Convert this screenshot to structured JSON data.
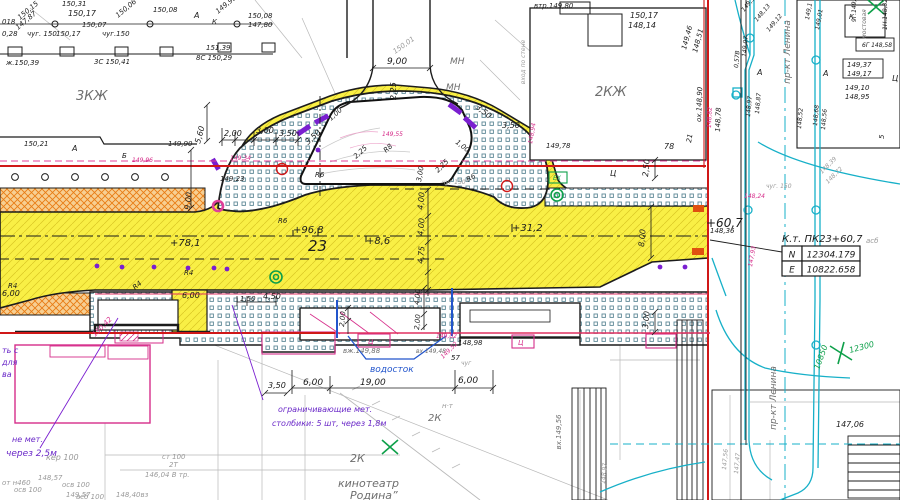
{
  "palette": {
    "k": "#1c1c1c",
    "g": "#9a9a9a",
    "G": "#6e6e6e",
    "p": "#d62d8a",
    "P": "#6a28c8",
    "r": "#d01818",
    "b": "#2255cc",
    "c": "#15aabb",
    "n": "#0ea04a",
    "o": "#e06010",
    "road_yellow": "#f9ef45",
    "orange": "#e87c14",
    "stipple": "#5e8896"
  },
  "coord_table": {
    "title": "К.т. ПК23+60,7",
    "rows": [
      {
        "label": "N",
        "value": "12304.179"
      },
      {
        "label": "E",
        "value": "10822.658"
      }
    ]
  },
  "labels": [
    {
      "t": "150,31",
      "x": 62,
      "y": 6
    },
    {
      "t": "150,15",
      "x": 20,
      "y": 20,
      "r": -40
    },
    {
      "t": "147,87",
      "x": 18,
      "y": 30,
      "r": -40
    },
    {
      "t": "150,17",
      "x": 68,
      "y": 16,
      "s": 8
    },
    {
      "t": "150,06",
      "x": 118,
      "y": 18,
      "r": -40
    },
    {
      "t": "150,08",
      "x": 153,
      "y": 12
    },
    {
      "t": "А",
      "x": 194,
      "y": 18,
      "s": 8
    },
    {
      "t": "К",
      "x": 212,
      "y": 24
    },
    {
      "t": "149,93",
      "x": 218,
      "y": 14,
      "r": -40
    },
    {
      "t": "150,08",
      "x": 248,
      "y": 18
    },
    {
      "t": "147,80",
      "x": 248,
      "y": 27
    },
    {
      "t": "018",
      "x": 2,
      "y": 24
    },
    {
      "t": "0,28",
      "x": 2,
      "y": 36
    },
    {
      "t": "чуг. 150",
      "x": 27,
      "y": 36
    },
    {
      "t": "150,17",
      "x": 56,
      "y": 36
    },
    {
      "t": "чуг.150",
      "x": 102,
      "y": 36
    },
    {
      "t": "150,07",
      "x": 82,
      "y": 27
    },
    {
      "t": "ж.150,39",
      "x": 6,
      "y": 65
    },
    {
      "t": "3С 150,41",
      "x": 94,
      "y": 64
    },
    {
      "t": "8С 150,29",
      "x": 196,
      "y": 60
    },
    {
      "t": "151,39",
      "x": 206,
      "y": 50
    },
    {
      "t": "3КЖ",
      "x": 76,
      "y": 100,
      "s": 13,
      "c": "G"
    },
    {
      "t": "150,21",
      "x": 24,
      "y": 146
    },
    {
      "t": "А",
      "x": 72,
      "y": 151,
      "s": 8
    },
    {
      "t": "149,90",
      "x": 168,
      "y": 146
    },
    {
      "t": "Б",
      "x": 122,
      "y": 158
    },
    {
      "t": "149,96",
      "x": 132,
      "y": 162,
      "c": "p",
      "s": 6
    },
    {
      "t": "9,00",
      "x": 387,
      "y": 64,
      "s": 9
    },
    {
      "t": "150,01",
      "x": 395,
      "y": 54,
      "r": -35,
      "c": "g"
    },
    {
      "t": "МН",
      "x": 450,
      "y": 64,
      "s": 9,
      "c": "G"
    },
    {
      "t": "МН",
      "x": 446,
      "y": 90,
      "s": 9,
      "c": "G"
    },
    {
      "t": "2,25",
      "x": 396,
      "y": 100,
      "r": -90,
      "s": 8
    },
    {
      "t": "втр.149,80",
      "x": 534,
      "y": 8
    },
    {
      "t": "2,00",
      "x": 224,
      "y": 136,
      "s": 8
    },
    {
      "t": "3,00",
      "x": 256,
      "y": 133,
      "s": 8
    },
    {
      "t": "3,50",
      "x": 279,
      "y": 136,
      "s": 8
    },
    {
      "t": "5,60",
      "x": 200,
      "y": 144,
      "r": -75,
      "s": 8
    },
    {
      "t": "3,50",
      "x": 308,
      "y": 145,
      "r": -42,
      "s": 8
    },
    {
      "t": "1,00",
      "x": 331,
      "y": 121,
      "r": -42
    },
    {
      "t": "2,25",
      "x": 356,
      "y": 159,
      "r": -42
    },
    {
      "t": "R8",
      "x": 386,
      "y": 153,
      "r": -42
    },
    {
      "t": "R6",
      "x": 315,
      "y": 177
    },
    {
      "t": "R6",
      "x": 468,
      "y": 182,
      "r": -30
    },
    {
      "t": "3,00",
      "x": 421,
      "y": 182,
      "r": -80
    },
    {
      "t": "2,25",
      "x": 438,
      "y": 173,
      "r": -45
    },
    {
      "t": "1,00",
      "x": 455,
      "y": 143,
      "r": 38
    },
    {
      "t": "3,50",
      "x": 475,
      "y": 108,
      "r": 38,
      "s": 8
    },
    {
      "t": "3,50",
      "x": 502,
      "y": 128,
      "s": 8
    },
    {
      "t": "149,55",
      "x": 382,
      "y": 136,
      "c": "p",
      "s": 6
    },
    {
      "t": "чуг 150",
      "x": 442,
      "y": 184,
      "c": "g",
      "s": 6
    },
    {
      "t": "9,00",
      "x": 190,
      "y": 210,
      "r": -85,
      "s": 8
    },
    {
      "t": "149,78",
      "x": 546,
      "y": 148
    },
    {
      "t": "148,94",
      "x": 532,
      "y": 144,
      "r": -80,
      "c": "p",
      "s": 6
    },
    {
      "t": "149,34",
      "x": 230,
      "y": 160,
      "c": "p",
      "s": 6
    },
    {
      "t": "149,23",
      "x": 220,
      "y": 181
    },
    {
      "t": "150,17",
      "x": 630,
      "y": 18,
      "s": 8
    },
    {
      "t": "148,14",
      "x": 628,
      "y": 28,
      "s": 8
    },
    {
      "t": "2КЖ",
      "x": 595,
      "y": 96,
      "s": 13,
      "c": "G"
    },
    {
      "t": "149,46",
      "x": 686,
      "y": 50,
      "r": -75
    },
    {
      "t": "148,51",
      "x": 697,
      "y": 53,
      "r": -75
    },
    {
      "t": "149,37",
      "x": 744,
      "y": 12,
      "r": -50,
      "s": 6
    },
    {
      "t": "148,13",
      "x": 757,
      "y": 22,
      "r": -50,
      "s": 6
    },
    {
      "t": "149,12",
      "x": 769,
      "y": 32,
      "r": -50,
      "s": 6
    },
    {
      "t": "пр-кт Ленина",
      "x": 790,
      "y": 52,
      "r": -90,
      "s": 9,
      "c": "G",
      "a": "middle"
    },
    {
      "t": "149,1",
      "x": 809,
      "y": 20,
      "r": -80,
      "s": 6
    },
    {
      "t": "149,01",
      "x": 819,
      "y": 30,
      "r": -80,
      "s": 6
    },
    {
      "t": "ох.148,90",
      "x": 701,
      "y": 122,
      "r": -88
    },
    {
      "t": "148,82",
      "x": 711,
      "y": 128,
      "r": -88,
      "c": "p",
      "s": 6
    },
    {
      "t": "148,78",
      "x": 720,
      "y": 132,
      "r": -88
    },
    {
      "t": "78",
      "x": 664,
      "y": 149,
      "s": 8
    },
    {
      "t": "21",
      "x": 691,
      "y": 143,
      "r": -80
    },
    {
      "t": "мостовая",
      "x": 866,
      "y": 24,
      "r": -90,
      "s": 6,
      "c": "G",
      "a": "middle"
    },
    {
      "t": "К",
      "x": 849,
      "y": 19
    },
    {
      "t": "1Н.148,32",
      "x": 887,
      "y": 30,
      "r": -90,
      "s": 6
    },
    {
      "t": "9Г.149,46",
      "x": 856,
      "y": 22,
      "r": -90,
      "s": 6
    },
    {
      "t": "6Г 148,58",
      "x": 862,
      "y": 47,
      "s": 6
    },
    {
      "t": "149,37",
      "x": 847,
      "y": 67
    },
    {
      "t": "149,17",
      "x": 847,
      "y": 76
    },
    {
      "t": "149,10",
      "x": 845,
      "y": 90
    },
    {
      "t": "148,95",
      "x": 845,
      "y": 99
    },
    {
      "t": "Ц",
      "x": 892,
      "y": 81,
      "s": 8
    },
    {
      "t": "5",
      "x": 884,
      "y": 139,
      "r": -90
    },
    {
      "t": "А",
      "x": 757,
      "y": 75,
      "s": 8
    },
    {
      "t": "А",
      "x": 823,
      "y": 76,
      "s": 8
    },
    {
      "t": "149,07",
      "x": 746,
      "y": 57,
      "r": -85,
      "s": 6
    },
    {
      "t": "0,57В",
      "x": 738,
      "y": 68,
      "r": -85,
      "s": 6
    },
    {
      "t": "148,97",
      "x": 750,
      "y": 117,
      "r": -85,
      "s": 6
    },
    {
      "t": "148,87",
      "x": 759,
      "y": 114,
      "r": -85,
      "s": 6
    },
    {
      "t": "148,68",
      "x": 817,
      "y": 126,
      "r": -85,
      "s": 6
    },
    {
      "t": "148,56",
      "x": 825,
      "y": 130,
      "r": -85,
      "s": 6
    },
    {
      "t": "148,52",
      "x": 801,
      "y": 129,
      "r": -85,
      "s": 6
    },
    {
      "t": "чуг. 150",
      "x": 766,
      "y": 188,
      "c": "g",
      "s": 6
    },
    {
      "t": "148,24",
      "x": 744,
      "y": 198,
      "c": "p",
      "s": 6
    },
    {
      "t": "148,39",
      "x": 822,
      "y": 174,
      "r": -45,
      "c": "g",
      "s": 6
    },
    {
      "t": "148,72",
      "x": 828,
      "y": 184,
      "r": -45,
      "c": "g",
      "s": 6
    },
    {
      "t": "Ц",
      "x": 610,
      "y": 176,
      "s": 8
    },
    {
      "t": "вход по стене",
      "x": 525,
      "y": 62,
      "r": -90,
      "s": 6,
      "c": "g",
      "a": "middle"
    },
    {
      "t": "+78,1",
      "x": 170,
      "y": 246,
      "s": 10
    },
    {
      "t": "+96,8",
      "x": 293,
      "y": 233,
      "s": 10
    },
    {
      "t": "23",
      "x": 308,
      "y": 251,
      "s": 15
    },
    {
      "t": "+8,6",
      "x": 366,
      "y": 244,
      "s": 10
    },
    {
      "t": "+31,2",
      "x": 512,
      "y": 231,
      "s": 10
    },
    {
      "t": "+60,7",
      "x": 706,
      "y": 227,
      "s": 12
    },
    {
      "t": "4,00",
      "x": 423,
      "y": 210,
      "r": -85,
      "s": 8
    },
    {
      "t": "4,00",
      "x": 423,
      "y": 236,
      "r": -85,
      "s": 8
    },
    {
      "t": "4,75",
      "x": 423,
      "y": 264,
      "r": -85,
      "s": 8
    },
    {
      "t": "R6",
      "x": 278,
      "y": 223
    },
    {
      "t": "R4",
      "x": 8,
      "y": 288
    },
    {
      "t": "R4",
      "x": 135,
      "y": 290,
      "r": -40
    },
    {
      "t": "R4",
      "x": 184,
      "y": 275
    },
    {
      "t": "6,00",
      "x": 182,
      "y": 298,
      "s": 8
    },
    {
      "t": "6,00",
      "x": 2,
      "y": 296,
      "s": 8
    },
    {
      "t": "1,50",
      "x": 240,
      "y": 301
    },
    {
      "t": "4,50",
      "x": 263,
      "y": 299,
      "s": 8
    },
    {
      "t": "2,50",
      "x": 648,
      "y": 177,
      "r": -85,
      "s": 8
    },
    {
      "t": "8,00",
      "x": 644,
      "y": 247,
      "r": -85,
      "s": 8
    },
    {
      "t": "148,36",
      "x": 710,
      "y": 233
    },
    {
      "t": "147,93",
      "x": 752,
      "y": 267,
      "r": -80,
      "c": "p",
      "s": 6
    },
    {
      "t": "асб",
      "x": 866,
      "y": 243,
      "c": "g"
    },
    {
      "t": "2,00",
      "x": 344,
      "y": 327,
      "r": -85
    },
    {
      "t": "4,00",
      "x": 419,
      "y": 305,
      "r": -85
    },
    {
      "t": "2,00",
      "x": 419,
      "y": 330,
      "r": -85
    },
    {
      "t": "149,02",
      "x": 436,
      "y": 338,
      "c": "p",
      "s": 6
    },
    {
      "t": "148,98",
      "x": 458,
      "y": 345
    },
    {
      "t": "вх 149,48",
      "x": 416,
      "y": 353,
      "c": "G",
      "s": 6
    },
    {
      "t": "57",
      "x": 451,
      "y": 360
    },
    {
      "t": "чуг",
      "x": 461,
      "y": 365,
      "c": "g",
      "s": 6
    },
    {
      "t": "149,52",
      "x": 443,
      "y": 359,
      "r": -45,
      "c": "p",
      "s": 6
    },
    {
      "t": "вж.149,88",
      "x": 343,
      "y": 353,
      "c": "G"
    },
    {
      "t": "Ц",
      "x": 368,
      "y": 344,
      "c": "p"
    },
    {
      "t": "Ц",
      "x": 518,
      "y": 345,
      "c": "p"
    },
    {
      "t": "водосток",
      "x": 370,
      "y": 372,
      "s": 9,
      "c": "b"
    },
    {
      "t": "6,00",
      "x": 303,
      "y": 385,
      "s": 9
    },
    {
      "t": "19,00",
      "x": 360,
      "y": 385,
      "s": 9
    },
    {
      "t": "6,00",
      "x": 458,
      "y": 383,
      "s": 9
    },
    {
      "t": "3,50",
      "x": 268,
      "y": 388,
      "s": 8
    },
    {
      "t": "ограничивающие мет.",
      "x": 278,
      "y": 412,
      "s": 8,
      "c": "P"
    },
    {
      "t": "столбики: 5 шт, через 1,8м",
      "x": 272,
      "y": 426,
      "s": 8,
      "c": "P"
    },
    {
      "t": "ть с",
      "x": 2,
      "y": 353,
      "s": 8,
      "c": "P"
    },
    {
      "t": "для",
      "x": 2,
      "y": 365,
      "s": 8,
      "c": "P"
    },
    {
      "t": "ва",
      "x": 2,
      "y": 377,
      "s": 8,
      "c": "P"
    },
    {
      "t": "не мет.",
      "x": 12,
      "y": 442,
      "s": 8,
      "c": "P"
    },
    {
      "t": "через 2,5м",
      "x": 6,
      "y": 456,
      "s": 9,
      "c": "P"
    },
    {
      "t": "150,42",
      "x": 95,
      "y": 337,
      "r": -45,
      "c": "p"
    },
    {
      "t": "н·т",
      "x": 442,
      "y": 408,
      "c": "g"
    },
    {
      "t": "2К",
      "x": 428,
      "y": 421,
      "s": 10,
      "c": "G"
    },
    {
      "t": "2К",
      "x": 350,
      "y": 462,
      "s": 11,
      "c": "G"
    },
    {
      "t": "кинотеатр",
      "x": 338,
      "y": 487,
      "s": 11,
      "c": "G"
    },
    {
      "t": "Родина”",
      "x": 350,
      "y": 499,
      "s": 11,
      "c": "G"
    },
    {
      "t": "кер 100",
      "x": 46,
      "y": 460,
      "s": 8,
      "c": "g"
    },
    {
      "t": "148,57",
      "x": 38,
      "y": 480,
      "c": "g"
    },
    {
      "t": "149,57",
      "x": 66,
      "y": 497,
      "c": "g"
    },
    {
      "t": "от н460",
      "x": 2,
      "y": 485,
      "c": "g"
    },
    {
      "t": "осв 100",
      "x": 14,
      "y": 492,
      "c": "g"
    },
    {
      "t": "осв 100",
      "x": 62,
      "y": 487,
      "c": "g"
    },
    {
      "t": "асб 100",
      "x": 76,
      "y": 499,
      "c": "g"
    },
    {
      "t": "148,40вз",
      "x": 116,
      "y": 497,
      "c": "g"
    },
    {
      "t": "ст 100",
      "x": 162,
      "y": 459,
      "c": "g"
    },
    {
      "t": "2Т",
      "x": 169,
      "y": 467,
      "c": "g"
    },
    {
      "t": "146,04 В тр.",
      "x": 145,
      "y": 477,
      "c": "g"
    },
    {
      "t": "вх.149,56",
      "x": 561,
      "y": 432,
      "r": -90,
      "c": "G",
      "a": "middle"
    },
    {
      "t": "147,06",
      "x": 836,
      "y": 427,
      "s": 8
    },
    {
      "t": "пр-кт Ленина",
      "x": 776,
      "y": 398,
      "r": -90,
      "s": 9,
      "c": "G",
      "a": "middle"
    },
    {
      "t": "12300",
      "x": 850,
      "y": 353,
      "r": -15,
      "s": 8,
      "c": "n"
    },
    {
      "t": "10850",
      "x": 819,
      "y": 370,
      "r": -70,
      "s": 8,
      "c": "n"
    },
    {
      "t": "147,56",
      "x": 726,
      "y": 470,
      "r": -85,
      "s": 6,
      "c": "g"
    },
    {
      "t": "147,47",
      "x": 738,
      "y": 474,
      "r": -85,
      "s": 6,
      "c": "g"
    },
    {
      "t": "148,97",
      "x": 605,
      "y": 484,
      "r": -85,
      "s": 6,
      "c": "g"
    },
    {
      "t": "3,00",
      "x": 648,
      "y": 329,
      "r": -85,
      "s": 8
    },
    {
      "t": "ЕХ",
      "x": 553,
      "y": 180,
      "s": 6,
      "c": "n"
    }
  ]
}
